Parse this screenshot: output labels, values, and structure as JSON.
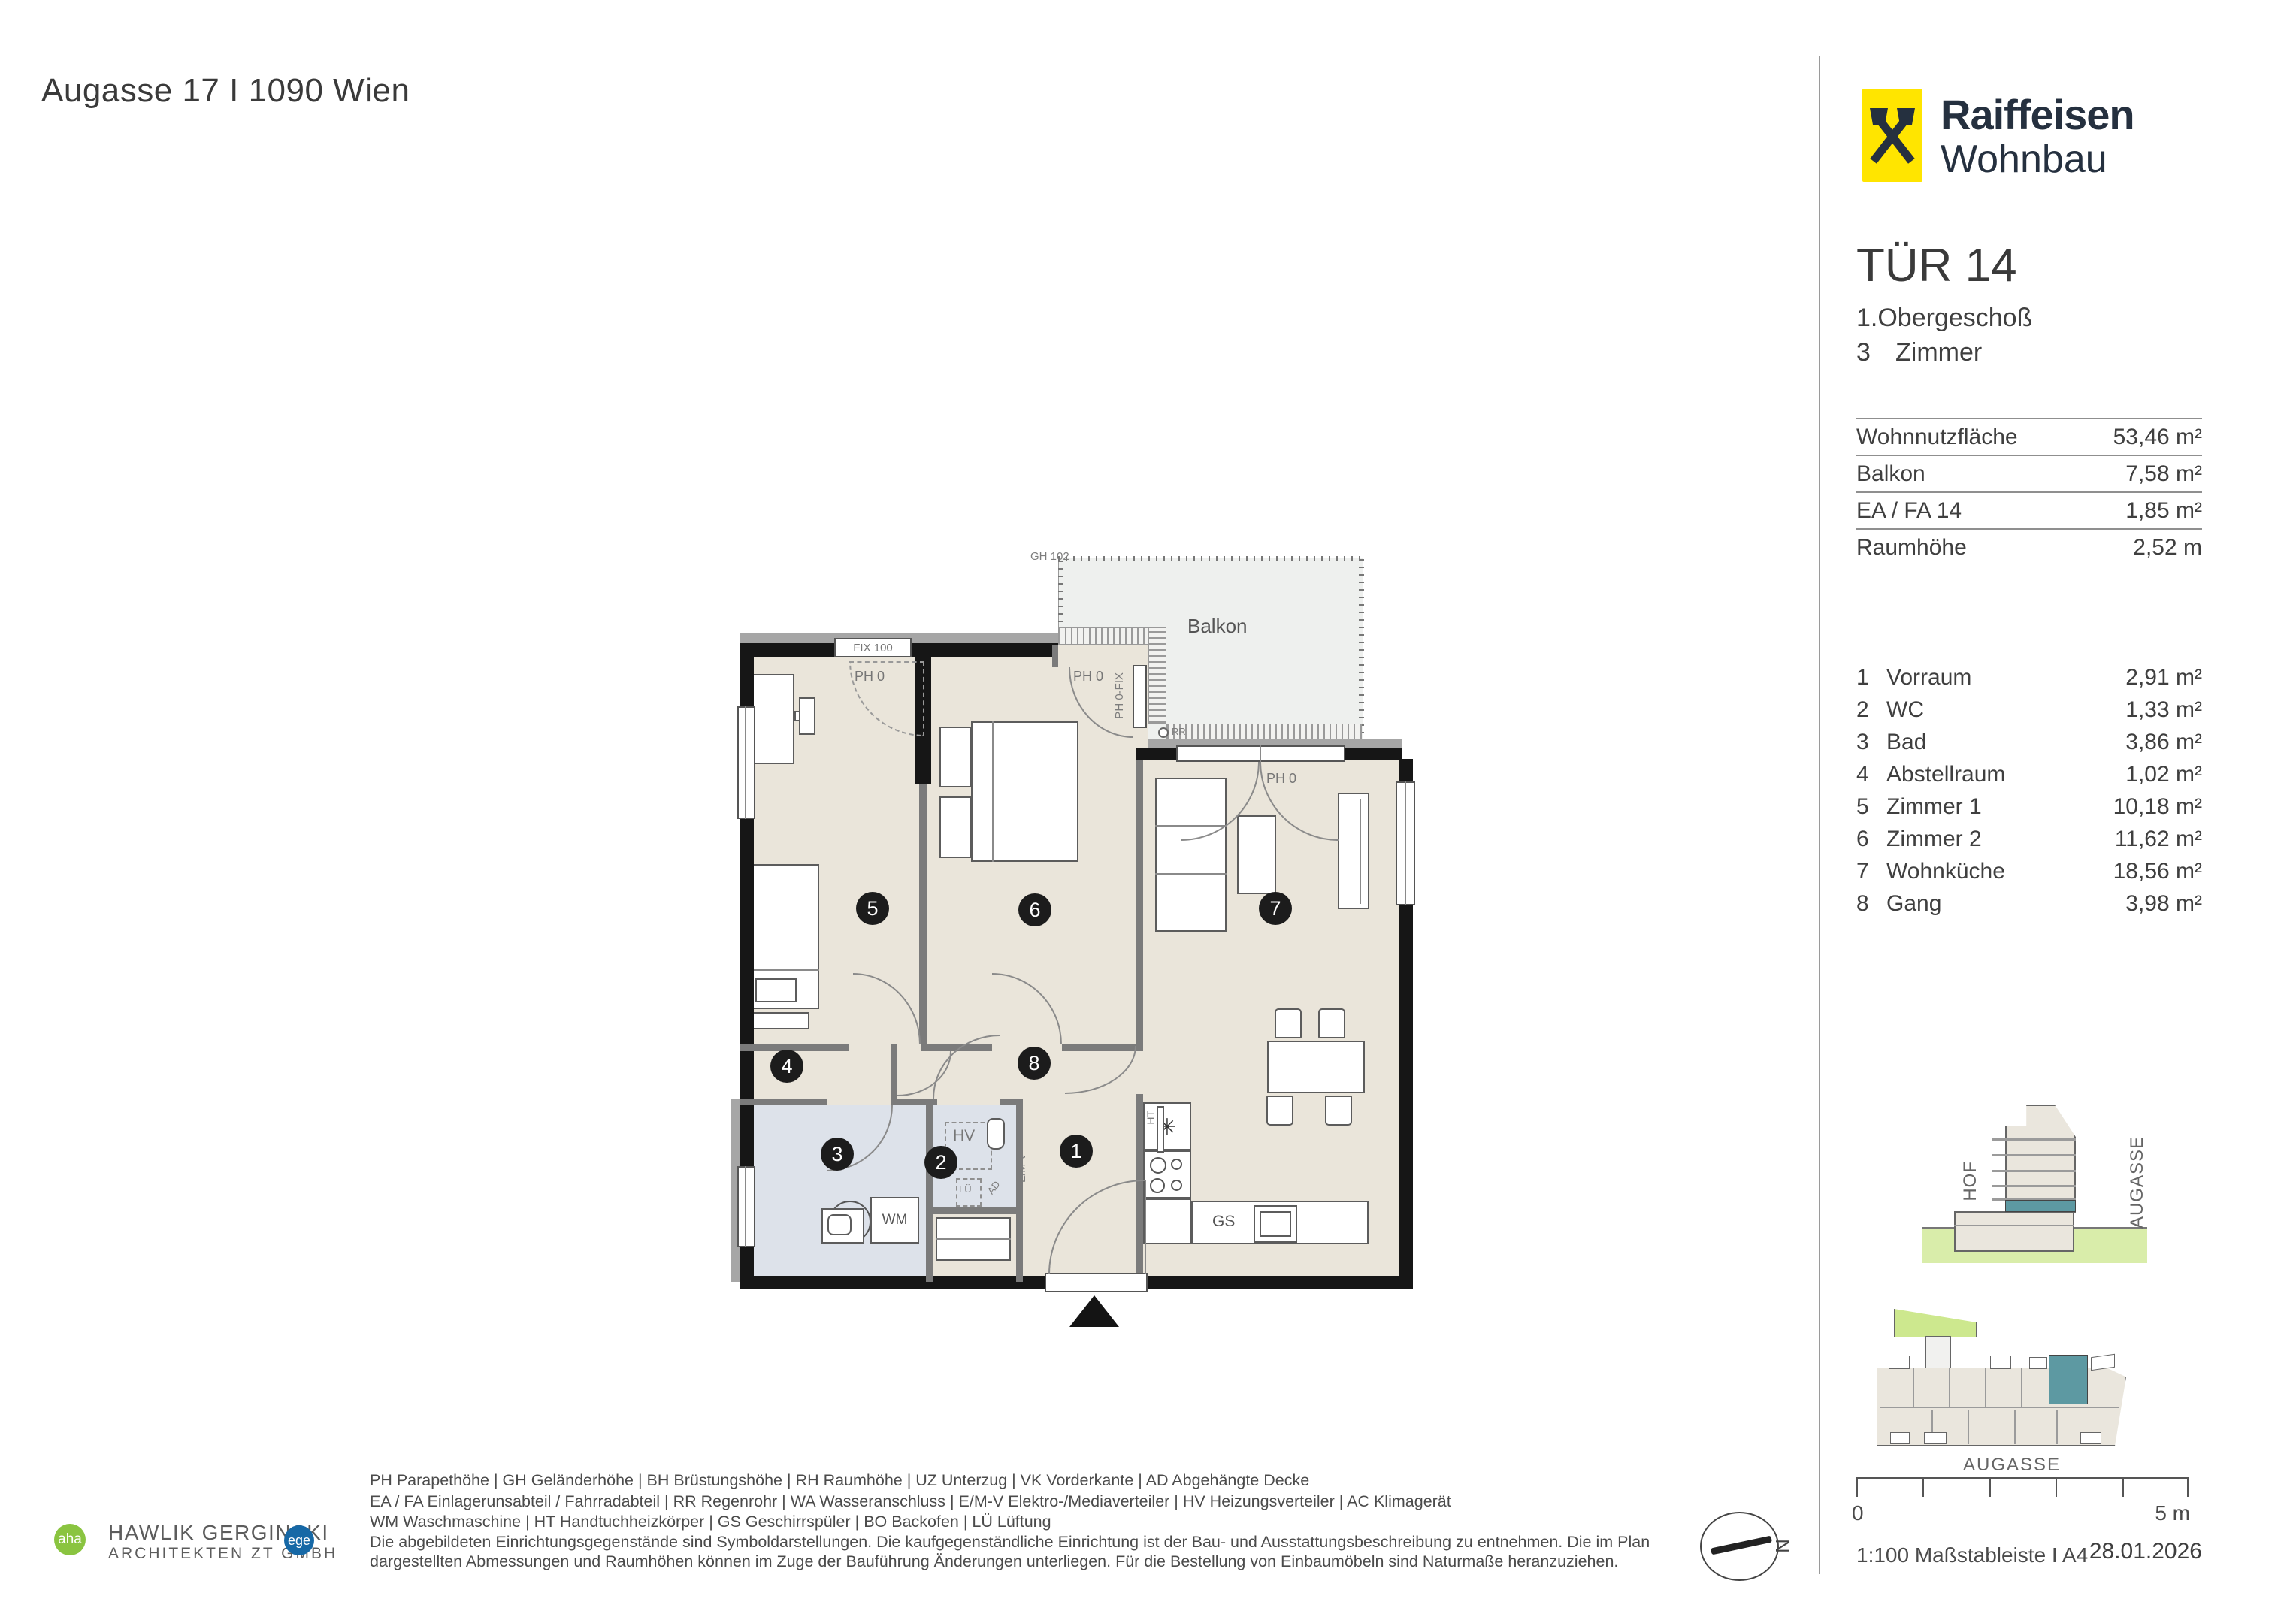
{
  "header": {
    "address": "Augasse 17 I 1090 Wien"
  },
  "brand": {
    "line1": "Raiffeisen",
    "line2": "Wohnbau"
  },
  "unit": {
    "title": "TÜR 14",
    "floor": "1.Obergeschoß",
    "rooms_num": "3",
    "rooms_word": "Zimmer"
  },
  "summary": [
    {
      "label": "Wohnnutzfläche",
      "value": "53,46 m²"
    },
    {
      "label": "Balkon",
      "value": "7,58 m²"
    },
    {
      "label": "EA / FA  14",
      "value": "1,85 m²"
    },
    {
      "label": "Raumhöhe",
      "value": "2,52 m"
    }
  ],
  "room_list": [
    {
      "no": "1",
      "name": "Vorraum",
      "area": "2,91 m²"
    },
    {
      "no": "2",
      "name": "WC",
      "area": "1,33 m²"
    },
    {
      "no": "3",
      "name": "Bad",
      "area": "3,86 m²"
    },
    {
      "no": "4",
      "name": "Abstellraum",
      "area": "1,02 m²"
    },
    {
      "no": "5",
      "name": "Zimmer 1",
      "area": "10,18 m²"
    },
    {
      "no": "6",
      "name": "Zimmer 2",
      "area": "11,62 m²"
    },
    {
      "no": "7",
      "name": "Wohnküche",
      "area": "18,56 m²"
    },
    {
      "no": "8",
      "name": "Gang",
      "area": "3,98 m²"
    }
  ],
  "plan": {
    "balkon": "Balkon",
    "gh": "GH 102",
    "fix": "FIX 100",
    "ph0": "PH 0",
    "ph0fix": "PH 0-FIX",
    "hv": "HV",
    "lu": "LÜ",
    "ad": "AD",
    "emv": "E/M-V",
    "ht": "HT",
    "wm": "WM",
    "gs": "GS",
    "rr": "RR",
    "sink_icon": "✳",
    "badges": [
      "1",
      "2",
      "3",
      "4",
      "5",
      "6",
      "7",
      "8"
    ]
  },
  "site": {
    "hof": "HOF",
    "augasse_side": "AUGASSE",
    "augasse_street": "AUGASSE"
  },
  "scalebar": {
    "zero": "0",
    "max": "5 m"
  },
  "footer": {
    "scale_note": "1:100 Maßstableiste I A4",
    "date": "28.01.2026",
    "north": "N"
  },
  "legend": {
    "lines": [
      "PH Parapethöhe | GH Geländerhöhe | BH Brüstungshöhe  |  RH Raumhöhe | UZ Unterzug | VK Vorderkante | AD Abgehängte Decke",
      "EA / FA Einlagerunsabteil / Fahrradabteil | RR Regenrohr | WA Wasseranschluss | E/M-V Elektro-/Mediaverteiler | HV Heizungsverteiler | AC Klimagerät",
      "WM Waschmaschine | HT Handtuchheizkörper | GS Geschirrspüler | BO Backofen | LÜ Lüftung",
      "Die abgebildeten Einrichtungsgegenstände sind Symboldarstellungen. Die kaufgegenständliche Einrichtung ist der Bau- und Ausstattungsbeschreibung zu entnehmen. Die im Plan",
      "dargestellten Abmessungen und Raumhöhen können im Zuge der Bauführung Änderungen unterliegen. Für die Bestellung von Einbaumöbeln sind Naturmaße heranzuziehen."
    ]
  },
  "architect": {
    "badge_left": "aha",
    "line1": "HAWLIK GERGINSKI",
    "line2": "ARCHITEKTEN ZT GMBH",
    "badge_right": "ege"
  },
  "colors": {
    "accent_teal": "#5d99a2",
    "brand_yellow": "#ffe500",
    "brand_navy": "#25303f",
    "ground_green": "#d9edaa",
    "parcel_green": "#cde88e"
  }
}
